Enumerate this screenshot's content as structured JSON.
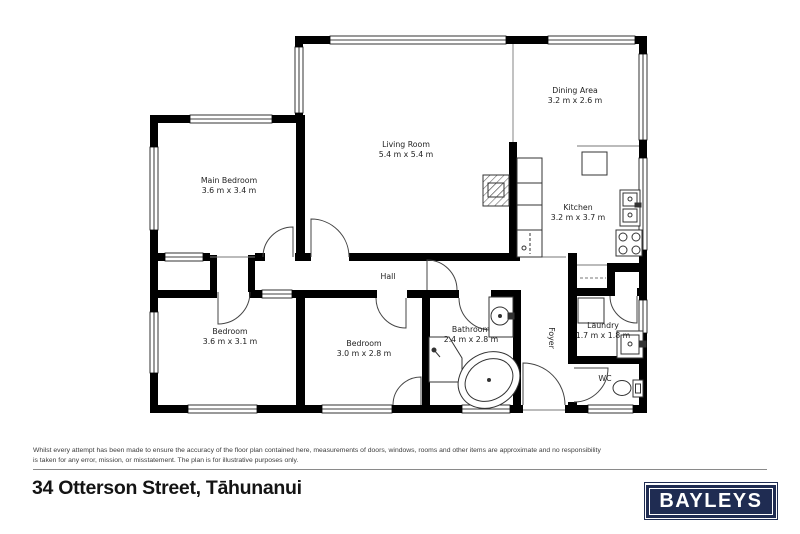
{
  "floor_plan": {
    "wall_color": "#000000",
    "rooms": {
      "main_bedroom": {
        "name": "Main Bedroom",
        "dims": "3.6 m x 3.4 m"
      },
      "living_room": {
        "name": "Living Room",
        "dims": "5.4 m x 5.4 m"
      },
      "dining_area": {
        "name": "Dining Area",
        "dims": "3.2 m x 2.6 m"
      },
      "kitchen": {
        "name": "Kitchen",
        "dims": "3.2 m x 3.7 m"
      },
      "bedroom_2": {
        "name": "Bedroom",
        "dims": "3.6 m x 3.1 m"
      },
      "bedroom_3": {
        "name": "Bedroom",
        "dims": "3.0 m x 2.8 m"
      },
      "bathroom": {
        "name": "Bathroom",
        "dims": "2.4 m x 2.8 m"
      },
      "laundry": {
        "name": "Laundry",
        "dims": "1.7 m x 1.8 m"
      },
      "hall": {
        "name": "Hall"
      },
      "foyer": {
        "name": "Foyer"
      },
      "wc": {
        "name": "WC"
      }
    }
  },
  "footer": {
    "disclaimer": "Whilst every attempt has been made to ensure the accuracy of the floor plan contained here, measurements of doors, windows, rooms and other items are approximate and no responsibility is taken for any error, mission, or misstatement. The plan is for illustrative purposes only.",
    "address": "34 Otterson Street, Tāhunanui",
    "brand": {
      "label": "BAYLEYS",
      "color": "#1f2c52"
    }
  }
}
